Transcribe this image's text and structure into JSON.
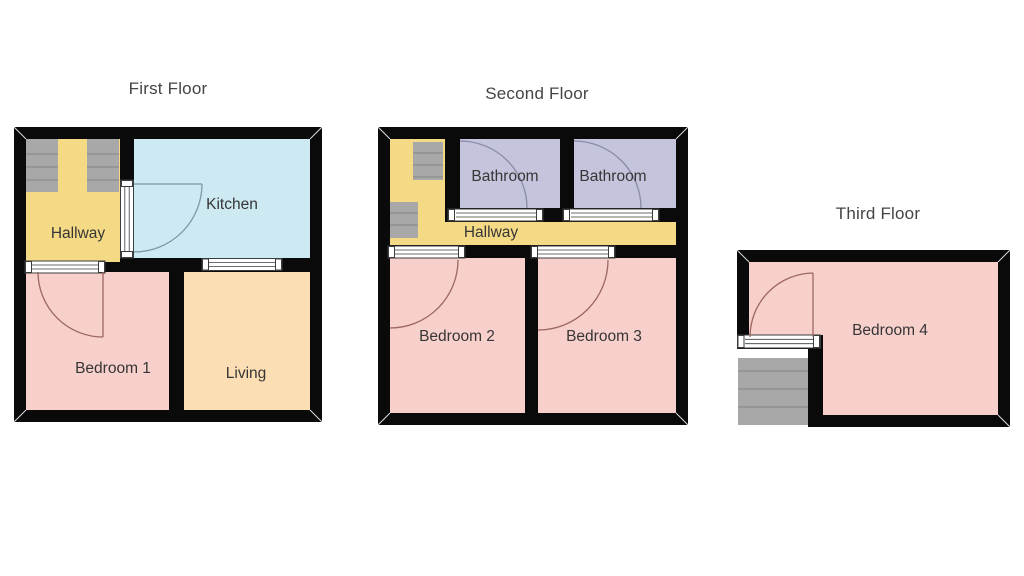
{
  "palette": {
    "wall": "#0a0a0a",
    "bedroom": "#f7cfcb",
    "hallway": "#f5da85",
    "kitchen": "#cde9f1",
    "living": "#fbdeb3",
    "bathroom": "#c4c5dc",
    "stairs": "#a8a8a8",
    "stair-line": "#8b8b8b",
    "bar-stroke": "#3c3c3c",
    "arc-bedroom": "#9c6664",
    "arc-kitchen": "#7e9aa6",
    "arc-bathroom": "#8a8aa8",
    "title-color": "#444444",
    "label-color": "#363636"
  },
  "floors": [
    {
      "title": "First Floor",
      "rooms": [
        {
          "name": "Hallway"
        },
        {
          "name": "Kitchen"
        },
        {
          "name": "Bedroom 1"
        },
        {
          "name": "Living"
        }
      ]
    },
    {
      "title": "Second Floor",
      "rooms": [
        {
          "name": "Bathroom"
        },
        {
          "name": "Bathroom"
        },
        {
          "name": "Hallway"
        },
        {
          "name": "Bedroom 2"
        },
        {
          "name": "Bedroom 3"
        }
      ]
    },
    {
      "title": "Third Floor",
      "rooms": [
        {
          "name": "Bedroom 4"
        }
      ]
    }
  ]
}
